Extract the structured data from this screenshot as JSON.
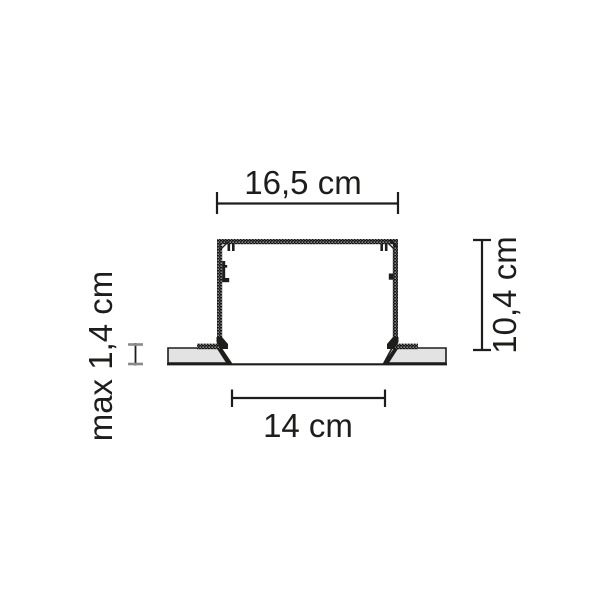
{
  "diagram": {
    "kind": "recessed-profile-cross-section",
    "dimensions": {
      "outer_width": {
        "label": "16,5 cm"
      },
      "height": {
        "label": "10,4 cm"
      },
      "cutout_width": {
        "label": "14 cm"
      },
      "max_panel_thickness": {
        "label": "max 1,4 cm"
      }
    },
    "colors": {
      "line": "#1d1d1b",
      "panel_fill": "#e3e3e3",
      "thickness_tick": "#8a8a8a"
    }
  }
}
